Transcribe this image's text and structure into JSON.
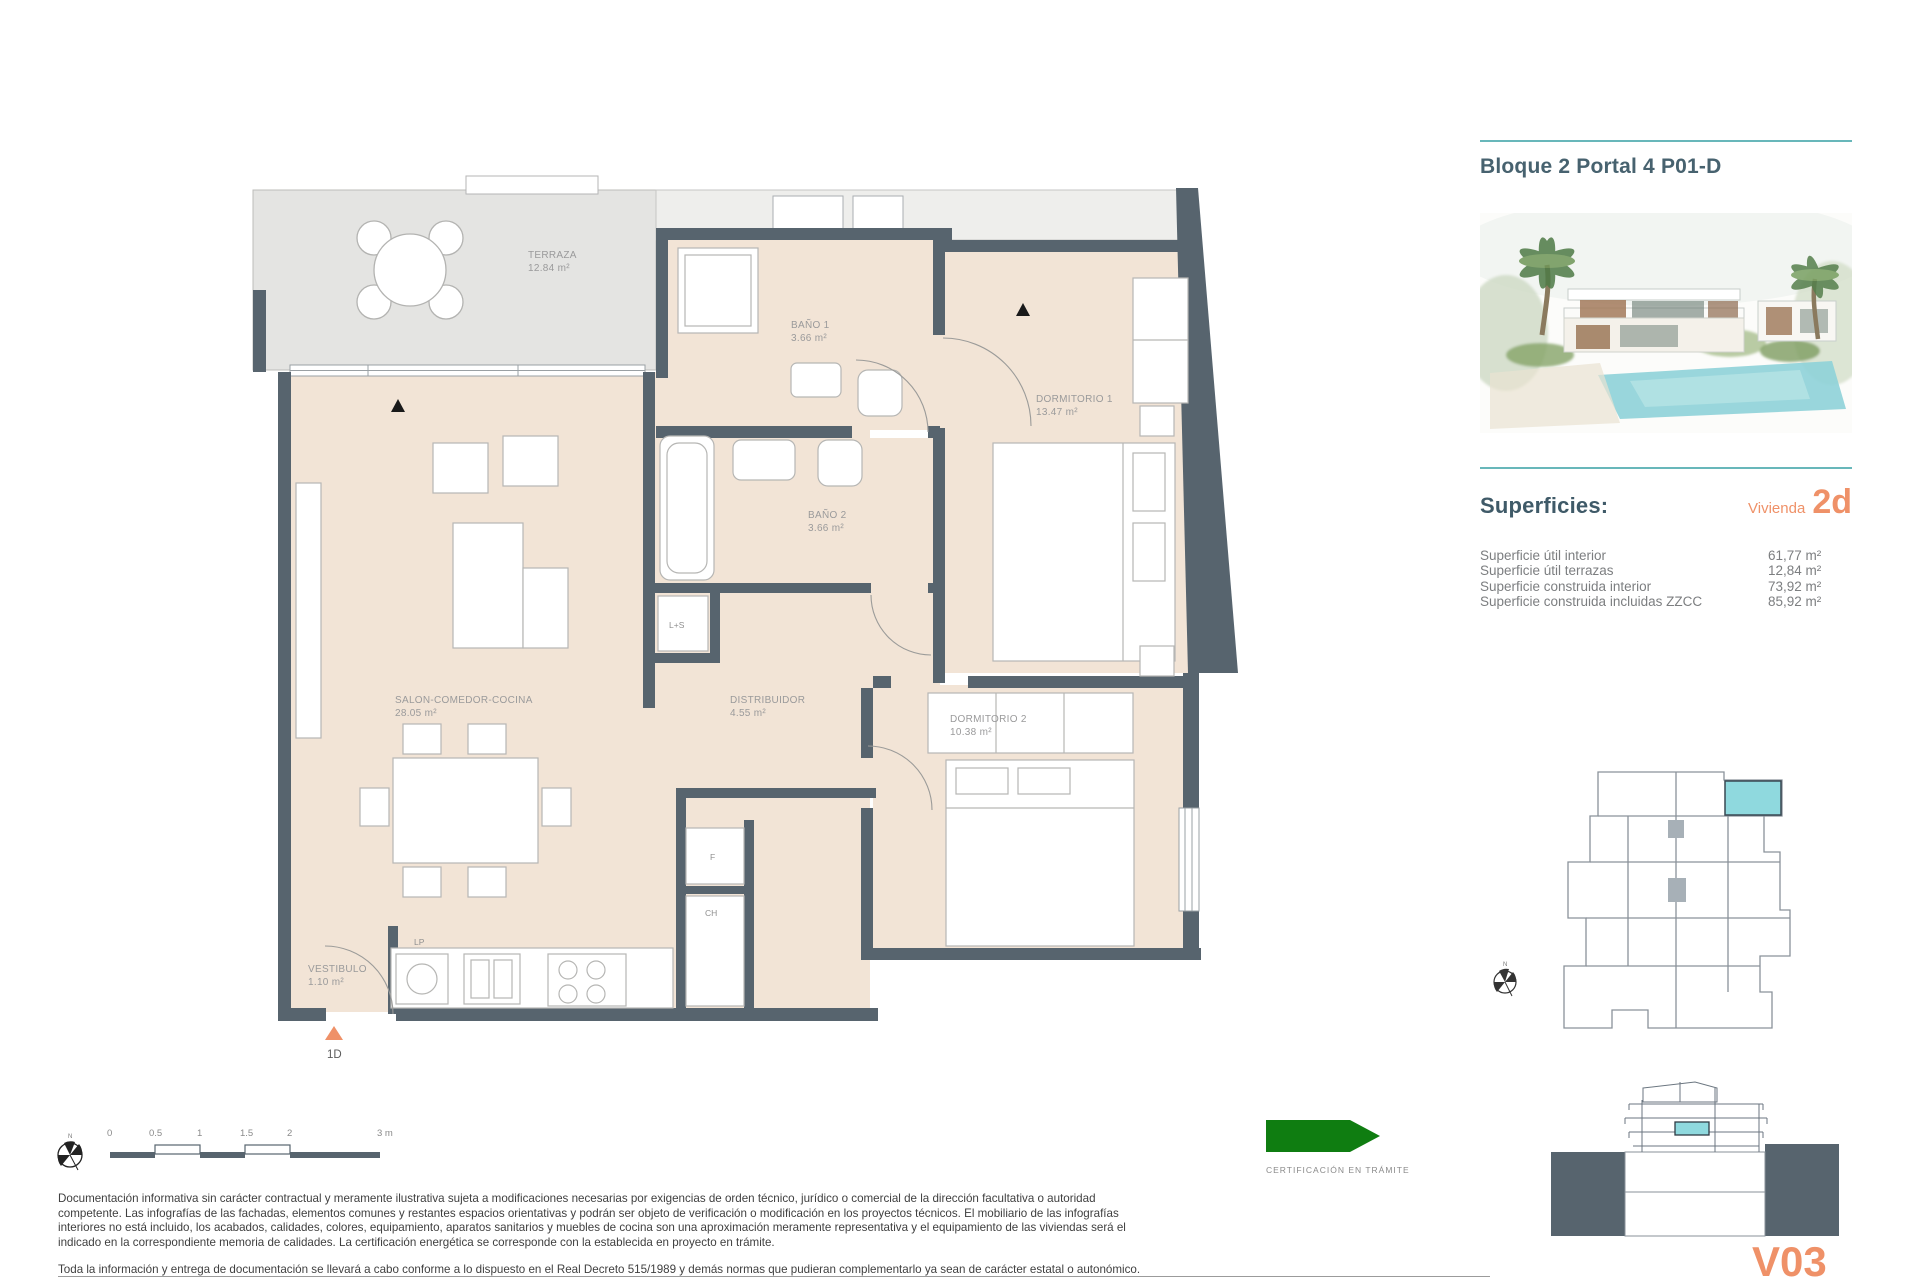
{
  "header": {
    "title": "Bloque 2 Portal 4 P01-D"
  },
  "superficies": {
    "heading": "Superficies:",
    "vivienda_label": "Vivienda",
    "vivienda_code": "2d",
    "rows": [
      {
        "label": "Superficie útil interior",
        "value": "61,77 m²"
      },
      {
        "label": "Superficie útil terrazas",
        "value": "12,84 m²"
      },
      {
        "label": "Superficie construida interior",
        "value": "73,92 m²"
      },
      {
        "label": "Superficie construida incluidas ZZCC",
        "value": "85,92 m²"
      }
    ]
  },
  "plan": {
    "rooms": {
      "terraza": {
        "name": "TERRAZA",
        "area": "12.84 m²"
      },
      "bano1": {
        "name": "BAÑO 1",
        "area": "3.66 m²"
      },
      "dormitorio1": {
        "name": "DORMITORIO 1",
        "area": "13.47 m²"
      },
      "bano2": {
        "name": "BAÑO 2",
        "area": "3.66 m²"
      },
      "salon": {
        "name": "SALON-COMEDOR-COCINA",
        "area": "28.05 m²"
      },
      "distribuidor": {
        "name": "DISTRIBUIDOR",
        "area": "4.55 m²"
      },
      "dormitorio2": {
        "name": "DORMITORIO 2",
        "area": "10.38 m²"
      },
      "vestibulo": {
        "name": "VESTIBULO",
        "area": "1.10 m²"
      }
    },
    "tags": {
      "ls": "L+S",
      "lp": "LP",
      "f": "F",
      "ch": "CH",
      "unit": "1D"
    },
    "compass_north": "N"
  },
  "scalebar": {
    "ticks": [
      "0",
      "0.5",
      "1",
      "1.5",
      "2",
      "3 m"
    ]
  },
  "certification": {
    "label": "CERTIFICACIÓN EN TRÁMITE"
  },
  "disclaimer": {
    "p1": "Documentación informativa sin carácter contractual y meramente ilustrativa sujeta a modificaciones necesarias por exigencias de orden técnico, jurídico o comercial de la dirección facultativa o autoridad competente. Las infografías de las fachadas, elementos comunes y restantes espacios orientativas y podrán ser objeto de verificación o modificación en los proyectos técnicos. El mobiliario de las infografías interiores no está incluido, los acabados, calidades, colores, equipamiento, aparatos sanitarios y muebles de cocina son una aproximación meramente representativa y el equipamiento de las viviendas será el indicado en la correspondiente memoria de calidades. La certificación energética se corresponde con la establecida en proyecto en trámite.",
    "p2": "Toda la información y entrega de documentación se llevará a cabo conforme a lo dispuesto en el Real Decreto 515/1989 y demás normas que pudieran complementarlo ya sean de carácter estatal o autonómico."
  },
  "version": "V03",
  "colors": {
    "wall": "#57646e",
    "interior": "#f2e4d6",
    "terrace": "#e4e4e2",
    "accent_teal": "#68b7ba",
    "accent_orange": "#ef9168",
    "unit_highlight": "#8fd9de",
    "certification_green": "#0f7d11"
  }
}
